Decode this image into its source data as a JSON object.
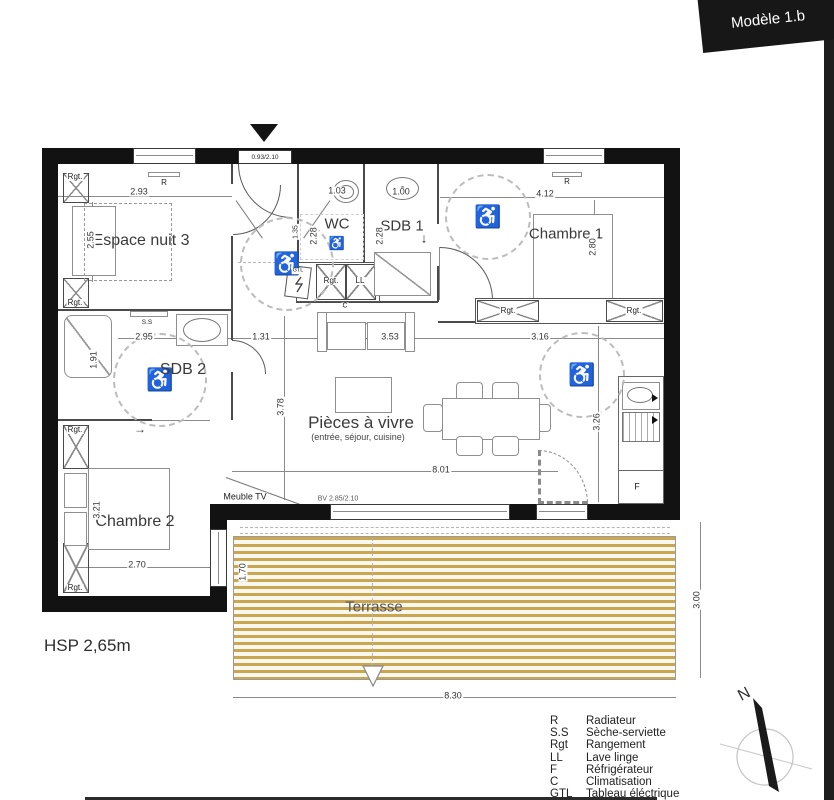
{
  "banner": {
    "title": "Modèle 1.b"
  },
  "plan": {
    "rooms": {
      "espace_nuit": "Espace nuit 3",
      "wc": "WC",
      "sdb1": "SDB 1",
      "chambre1": "Chambre 1",
      "sdb2": "SDB 2",
      "chambre2": "Chambre 2",
      "living": "Pièces à vivre",
      "living_sub": "(entrée, séjour, cuisine)",
      "terrasse": "Terrasse"
    },
    "dims": {
      "w293": "2.93",
      "h255": "2.55",
      "entry": "0.93/2.10",
      "w103": "1.03",
      "w100": "1.00",
      "h228": "2.28",
      "h135": "1.35",
      "w412": "4.12",
      "h280": "2.80",
      "w295": "2.95",
      "h191": "1.91",
      "w131": "1.31",
      "w353": "3.53",
      "w316": "3.16",
      "h378": "3.78",
      "h326": "3.26",
      "w801": "8.01",
      "h321": "3.21",
      "w270": "2.70",
      "h170": "1.70",
      "w830": "8.30",
      "h300": "3.00",
      "bay": "BV 2.85/2.10"
    },
    "ann": {
      "r": "R",
      "ss": "S.S",
      "rgt": "Rgt.",
      "ll": "LL",
      "c": "C",
      "gtl": "GTL",
      "f": "F",
      "tv": "Meuble TV",
      "hsp": "HSP 2,65m",
      "north": "N",
      "down": "↓",
      "right": "→",
      "wheelchair": "♿"
    }
  },
  "legend": {
    "rows": [
      {
        "abbr": "R",
        "label": "Radiateur"
      },
      {
        "abbr": "S.S",
        "label": "Sèche-serviette"
      },
      {
        "abbr": "Rgt",
        "label": "Rangement"
      },
      {
        "abbr": "LL",
        "label": "Lave linge"
      },
      {
        "abbr": "F",
        "label": "Réfrigérateur"
      },
      {
        "abbr": "C",
        "label": "Climatisation"
      },
      {
        "abbr": "GTL",
        "label": "Tableau éléctrique"
      }
    ]
  },
  "colors": {
    "wall": "#121212",
    "deck": "#c9a64f",
    "line": "#8a8a8a",
    "accent": "#171717"
  }
}
